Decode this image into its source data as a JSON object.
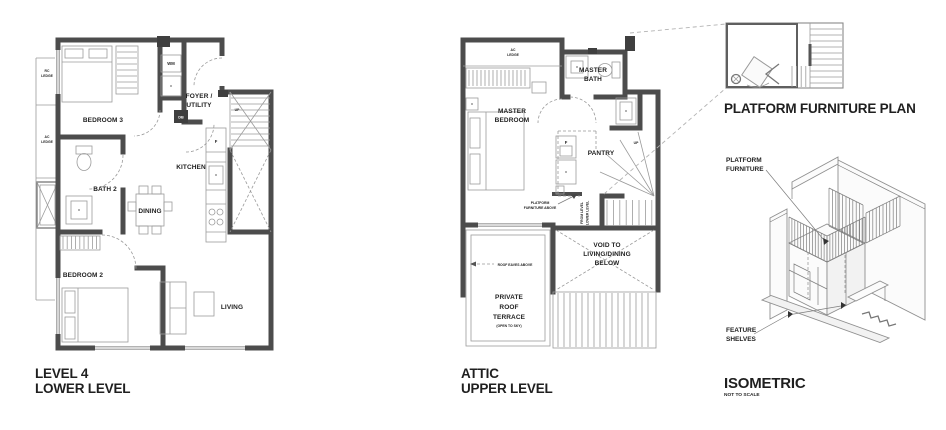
{
  "sheet": {
    "background": "#ffffff"
  },
  "lower_plan": {
    "caption": [
      "LEVEL 4",
      "LOWER LEVEL"
    ],
    "rooms": {
      "bedroom3": "BEDROOM 3",
      "bath2": "BATH 2",
      "foyer": [
        "FOYER /",
        "UTILITY"
      ],
      "kitchen": "KITCHEN",
      "dining": "DINING",
      "bedroom2": "BEDROOM 2",
      "living": "LIVING"
    },
    "notes": {
      "rc_ledge": [
        "RC",
        "LEDGE"
      ],
      "ac_ledge": [
        "AC",
        "LEDGE"
      ],
      "wm": "WM",
      "db": "DB",
      "fridge": "F",
      "up": "UP"
    }
  },
  "upper_plan": {
    "caption": [
      "ATTIC",
      "UPPER LEVEL"
    ],
    "rooms": {
      "master_bath": [
        "MASTER",
        "BATH"
      ],
      "master_bedroom": [
        "MASTER",
        "BEDROOM"
      ],
      "pantry": "PANTRY",
      "void": [
        "VOID TO",
        "LIVING/DINING",
        "BELOW"
      ],
      "terrace": [
        "PRIVATE",
        "ROOF",
        "TERRACE"
      ],
      "terrace_sub": "(OPEN TO SKY)"
    },
    "notes": {
      "ac_ledge": [
        "AC",
        "LEDGE"
      ],
      "fridge": "F",
      "up": "UP",
      "stair": [
        "FROM LEVEL",
        "LOWER LEVEL"
      ],
      "platform": [
        "PLATFORM",
        "FURNITURE ABOVE"
      ],
      "roof_eaves": "ROOF EAVES ABOVE"
    }
  },
  "detail_plan": {
    "caption": "PLATFORM FURNITURE PLAN"
  },
  "isometric": {
    "caption": "ISOMETRIC",
    "scale_note": "NOT TO SCALE",
    "labels": {
      "platform": [
        "PLATFORM",
        "FURNITURE"
      ],
      "shelves": [
        "FEATURE",
        "SHELVES"
      ]
    }
  }
}
